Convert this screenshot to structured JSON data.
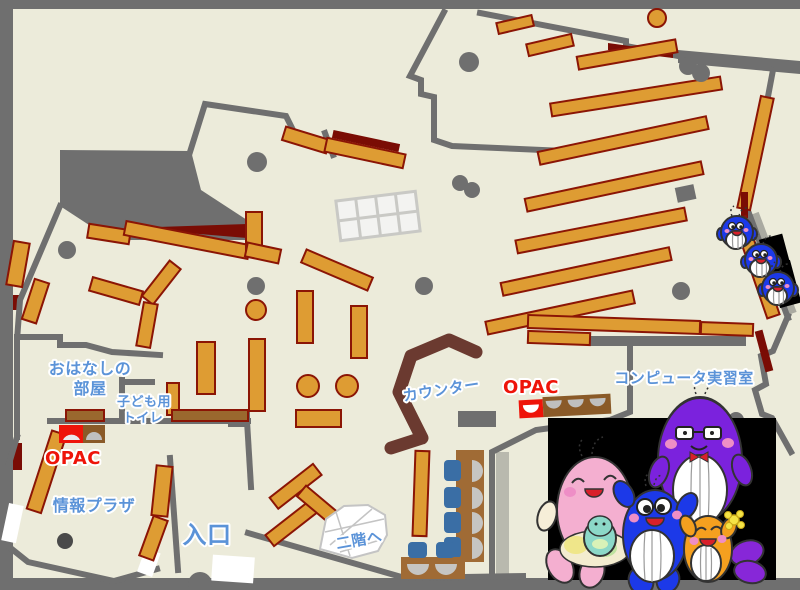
{
  "map": {
    "title": "Library first-floor map",
    "labels": {
      "story_room_line1": "おはなしの",
      "story_room_line2": "部屋",
      "kids_toilet_line1": "子ども用",
      "kids_toilet_line2": "トイレ",
      "opac_left": "OPAC",
      "opac_center": "OPAC",
      "info_plaza": "情報プラザ",
      "entrance": "入口",
      "to_second_floor": "二階へ",
      "counter": "カウンター",
      "computer_room": "コンピュータ実習室"
    },
    "colors": {
      "floor_cream": "#ECEBDA",
      "wall_grey": "#6F6F6F",
      "shelf_orange": "#DE9C33",
      "shelf_border_dark_red": "#8B1505",
      "accent_dark_red": "#7A0C04",
      "counter_brown": "#6B3A30",
      "desk_brown": "#A06B35",
      "chair_blue": "#3A6EA5",
      "label_blue": "#5B93D8",
      "opac_red": "#EE1409",
      "photo_black": "#000000"
    },
    "mascots": {
      "photo_group": [
        "pink-mascot-with-baby",
        "blue-mascot",
        "purple-mascot-with-glasses",
        "orange-mascot-with-flower"
      ],
      "mini_group": [
        "mini-blue-mascot-1",
        "mini-blue-mascot-2",
        "mini-blue-mascot-3"
      ]
    }
  }
}
